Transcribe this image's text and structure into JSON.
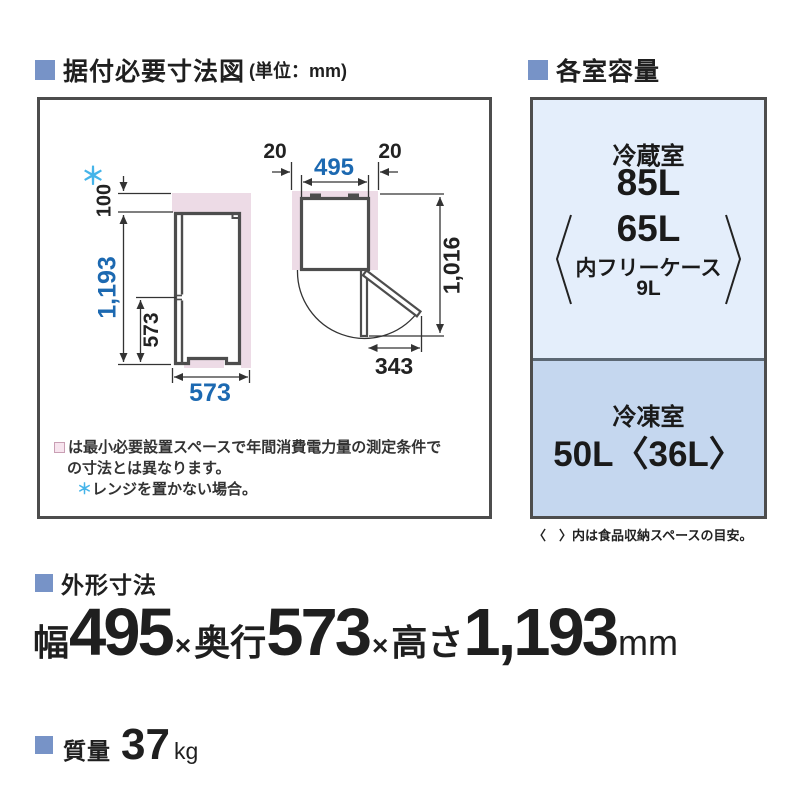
{
  "headers": {
    "install_title": "据付必要寸法図",
    "install_unit": "(単位：mm)",
    "capacity_title": "各室容量"
  },
  "diagram": {
    "asterisk": "＊",
    "dims": {
      "top_clearance": "100",
      "total_height": "1,193",
      "lower_section_height": "573",
      "depth": "573",
      "left_clearance": "20",
      "width": "495",
      "right_clearance": "20",
      "door_open_depth": "1,016",
      "door_protrusion": "343"
    },
    "notes": {
      "line1": "は最小必要設置スペースで年間消費電力量の測定条件で",
      "line2": "の寸法とは異なります。",
      "asterisk": "＊",
      "line3": "レンジを置かない場合。"
    }
  },
  "capacity": {
    "fridge_label": "冷蔵室",
    "fridge_value": "85L",
    "fridge_inner_value": "65L",
    "fridge_inner_label": "内フリーケース",
    "fridge_inner_sub": "9L",
    "freezer_label": "冷凍室",
    "freezer_value": "50L〈36L〉",
    "footnote": "〈　〉内は食品収納スペースの目安。"
  },
  "outer_dims": {
    "title": "外形寸法",
    "width_label": "幅",
    "width_value": "495",
    "sep1": "×",
    "depth_label": "奥行",
    "depth_value": "573",
    "sep2": "×",
    "height_label": "高さ",
    "height_value": "1,193",
    "unit": "mm"
  },
  "weight": {
    "title": "質量",
    "value": "37",
    "unit": "kg"
  },
  "colors": {
    "bullet_blue": "#7793c7",
    "dimension_blue": "#1c69b1",
    "asterisk_light_blue": "#45b4e9",
    "clearance_pink": "#eddbe6",
    "panel_light_blue": "#e4eefb",
    "panel_mid_blue": "#c5d7ef",
    "outline_gray": "#4d4d4d"
  }
}
